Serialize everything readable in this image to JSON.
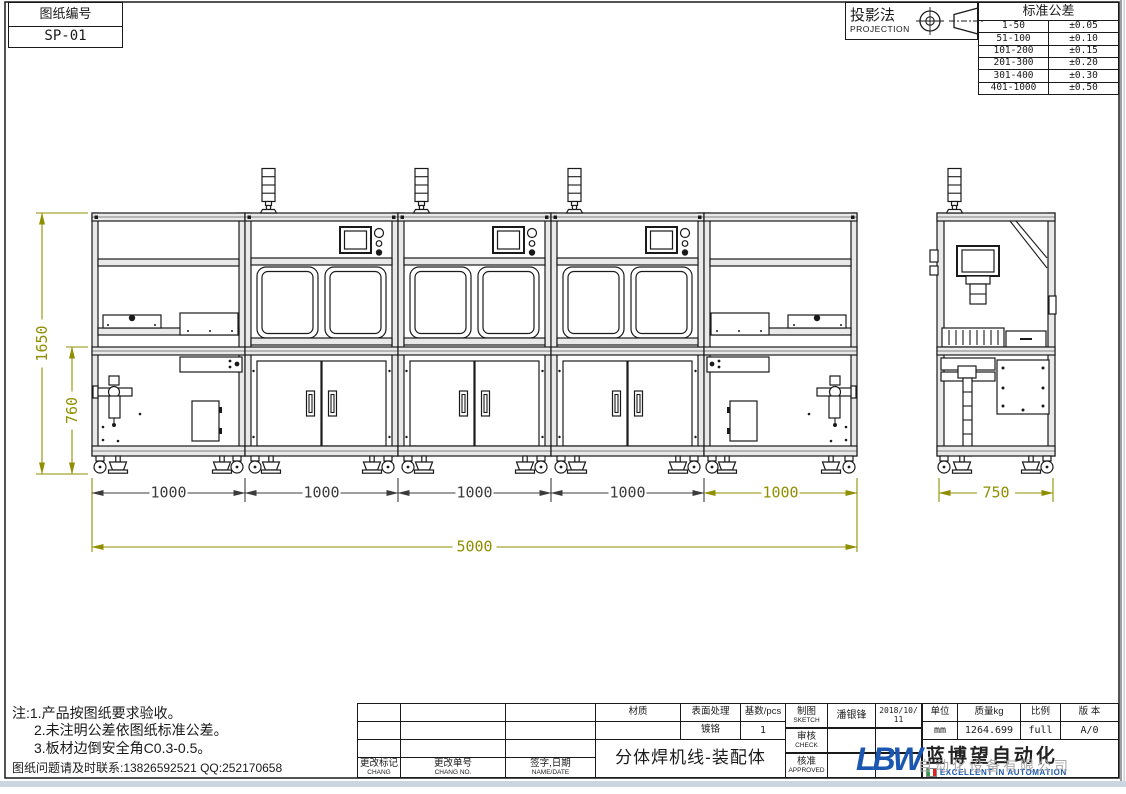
{
  "sheet": {
    "drawing_no_label": "图纸编号",
    "drawing_no_value": "SP-01"
  },
  "projection": {
    "label": "投影法",
    "label_en": "PROJECTION"
  },
  "tolerance": {
    "title": "标准公差",
    "rows": [
      [
        "1-50",
        "±0.05"
      ],
      [
        "51-100",
        "±0.10"
      ],
      [
        "101-200",
        "±0.15"
      ],
      [
        "201-300",
        "±0.20"
      ],
      [
        "301-400",
        "±0.30"
      ],
      [
        "401-1000",
        "±0.50"
      ]
    ]
  },
  "dimensions": {
    "height_total": "1650",
    "height_lower": "760",
    "bay_widths": [
      "1000",
      "1000",
      "1000",
      "1000",
      "1000"
    ],
    "total_width": "5000",
    "side_width": "750"
  },
  "notes": {
    "line1": "注:1.产品按图纸要求验收。",
    "line2": "2.未注明公差依图纸标准公差。",
    "line3": "3.板材边倒安全角C0.3-0.5。",
    "contact": "图纸问题请及时联系:13826592521 QQ:252170658"
  },
  "titleblock": {
    "material_label": "材质",
    "surface_label": "表面处理",
    "qty_label": "基数/pcs",
    "surface_value": "镀铬",
    "qty_value": "1",
    "change_mark": "更改标记",
    "change_mark_en": "CHANG",
    "change_no": "更改单号",
    "change_no_en": "CHANG NO.",
    "sign_date": "签字,日期",
    "sign_date_en": "NAME/DATE",
    "title": "分体焊机线-装配体",
    "sketch_label": "制图",
    "sketch_en": "SKETCH",
    "sketch_name": "潘银锋",
    "sketch_date": "2018/10/11",
    "check_label": "审核",
    "check_en": "CHECK",
    "approve_label": "核准",
    "approve_en": "APPROVED",
    "unit_label": "单位",
    "unit_value": "mm",
    "mass_label": "质量kg",
    "mass_value": "1264.699",
    "scale_label": "比例",
    "scale_value": "full",
    "version_label": "版 本",
    "version_value": "A/0"
  },
  "logo": {
    "abbr": "LBW",
    "cn": "蓝博望自动化",
    "ghost": "自动化设备有限公司",
    "en": "EXCELLENT IN AUTOMATION"
  }
}
